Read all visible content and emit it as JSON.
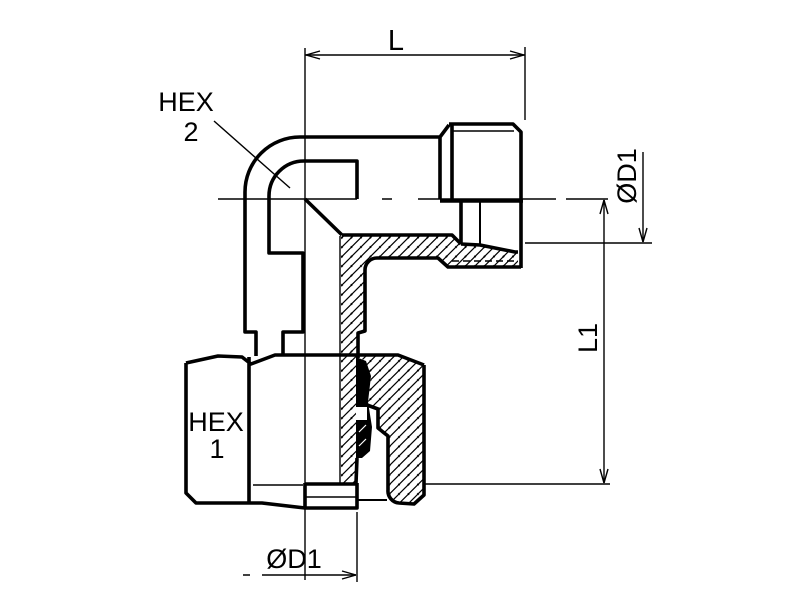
{
  "drawing": {
    "background_color": "#ffffff",
    "line_color": "#000000",
    "dimensions": {
      "top_length_label": "L",
      "side_length_label": "L1",
      "side_diameter_label": "ØD1",
      "bottom_diameter_label": "ØD1"
    },
    "part_labels": {
      "hex2_line1": "HEX",
      "hex2_line2": "2",
      "hex1_line1": "HEX",
      "hex1_line2": "1"
    }
  }
}
